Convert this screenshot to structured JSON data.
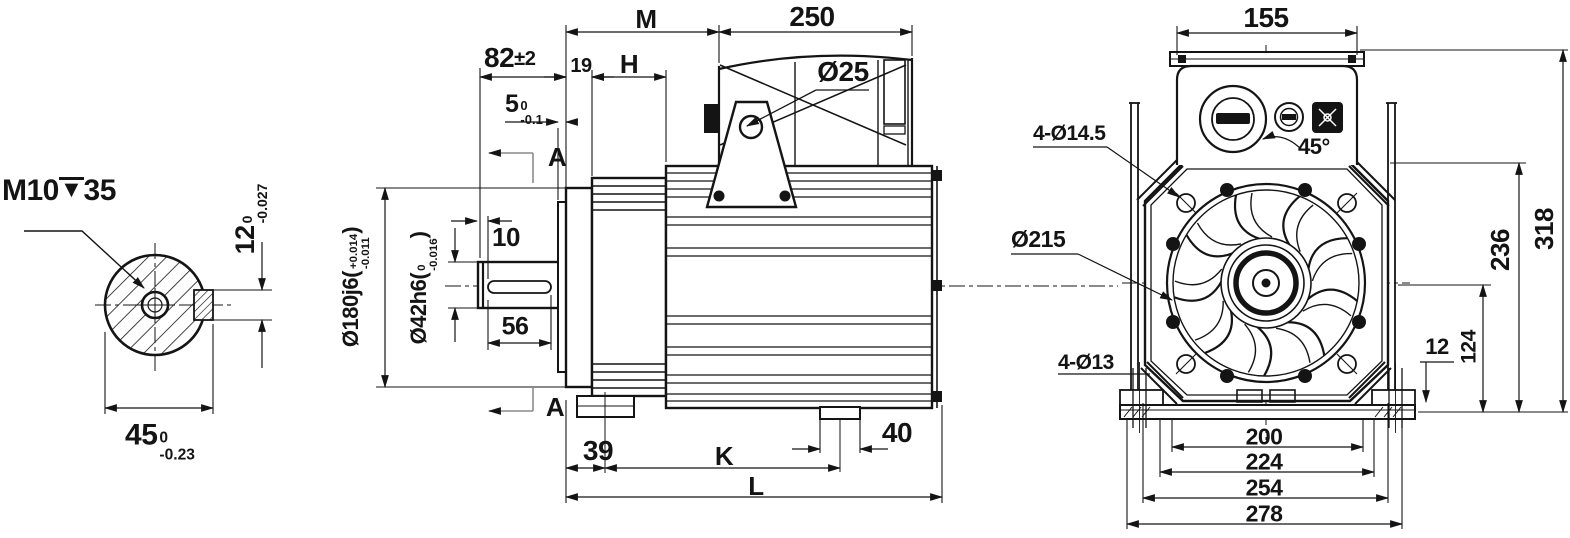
{
  "drawing_colors": {
    "line": "#141414",
    "section_arrow": "#8a8a8a",
    "background": "#ffffff"
  },
  "views": {
    "shaft_end_view": {
      "thread_callout": {
        "size": "M10",
        "depth_symbol": "▼",
        "depth": "35"
      },
      "key_height": {
        "value": "12",
        "tol_upper": "0",
        "tol_lower": "-0.027"
      },
      "width_over_key": {
        "value": "45",
        "tol_upper": "0",
        "tol_lower": "-0.23"
      }
    },
    "side_view": {
      "shaft_length": {
        "value": "82",
        "tol": "±2"
      },
      "spigot_depth": {
        "value": "5",
        "tol_upper": "0",
        "tol_lower": "-0.1"
      },
      "flange_thickness": "19",
      "dim_h": "H",
      "dim_m": "M",
      "terminal_box_length": "250",
      "eye_hole_dia": "Ø25",
      "keyway_end_offset": "10",
      "keyway_length": "56",
      "flange_dia": {
        "prefix": "Ø180j6(",
        "tol_upper": "+0.014",
        "tol_lower": "-0.011",
        "suffix": ")"
      },
      "shaft_dia": {
        "prefix": "Ø42h6(",
        "tol_upper": "0",
        "tol_lower": "-0.016",
        "suffix": ")"
      },
      "foot_offset": "39",
      "dim_k": "K",
      "foot_width": "40",
      "dim_l": "L",
      "section_label_top": "A",
      "section_label_bottom": "A"
    },
    "front_view": {
      "terminal_box_width": "155",
      "bolt_angle": "45°",
      "flange_holes": "4-Ø14.5",
      "shroud_dia": "Ø215",
      "body_top_height": "236",
      "overall_height": "318",
      "center_height": "124",
      "base_thickness": "12",
      "foot_holes": "4-Ø13",
      "bolt_span_1": "200",
      "bolt_span_2": "224",
      "bolt_span_3": "254",
      "base_width": "278"
    }
  }
}
